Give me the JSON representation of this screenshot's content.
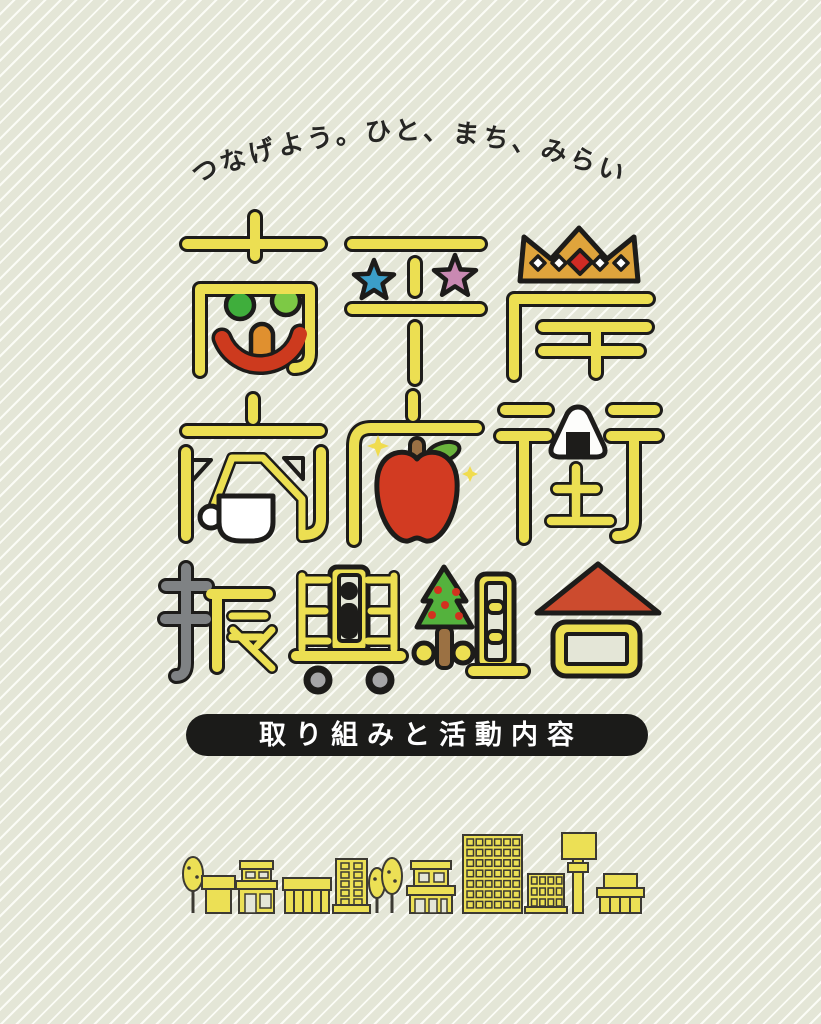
{
  "poster": {
    "tagline": {
      "text": "つなげよう。ひと、まち、みらい。"
    },
    "logo": {
      "name": "南平岸商店街振興組合",
      "line1": "南平岸",
      "line2": "商店街",
      "line3": "振興組合",
      "motifs": [
        "smiley-face",
        "blue-star",
        "pink-star",
        "crown",
        "coffee-cup",
        "apple",
        "sparkles",
        "rice-ball",
        "gray-hand-radical",
        "person-in-cart",
        "cart-wheels",
        "fir-tree",
        "red-house-roof"
      ]
    },
    "banner": {
      "label": "取り組みと活動内容"
    },
    "skyline": {
      "items": [
        "street-tree",
        "small-shop",
        "two-story-shop",
        "market-stalls",
        "tall-building",
        "street-trees",
        "mid-building",
        "office-building",
        "apartment-building",
        "signboard-pole",
        "low-building"
      ]
    },
    "colors": {
      "background": "#e4e6d7",
      "stripe": "#fcfdf8",
      "logo_yellow": "#ecdf52",
      "outline_black": "#1d1c1a",
      "banner_bg": "#1b1b19",
      "banner_text": "#ffffff",
      "crown_gold": "#dfa43c",
      "crown_diamond_red": "#cf2b24",
      "smile_red": "#cd3a1e",
      "nose_orange": "#e0902f",
      "eye_green_dark": "#3fae3c",
      "eye_green_light": "#7dc945",
      "star_blue": "#3b9ec8",
      "star_pink": "#c989b2",
      "apple_red": "#d23b22",
      "stem_brown": "#9a7044",
      "leaf_green": "#6ab33c",
      "tree_green": "#54b23d",
      "berry_red": "#d2311f",
      "trunk_brown": "#9b7143",
      "radical_gray": "#7f8284",
      "wheel_gray": "#a5a5a7",
      "roof_red": "#cc4b2e",
      "skyline_yellow": "#ece055",
      "skyline_outline": "#3c3a33",
      "tagline_text": "#262624"
    }
  }
}
